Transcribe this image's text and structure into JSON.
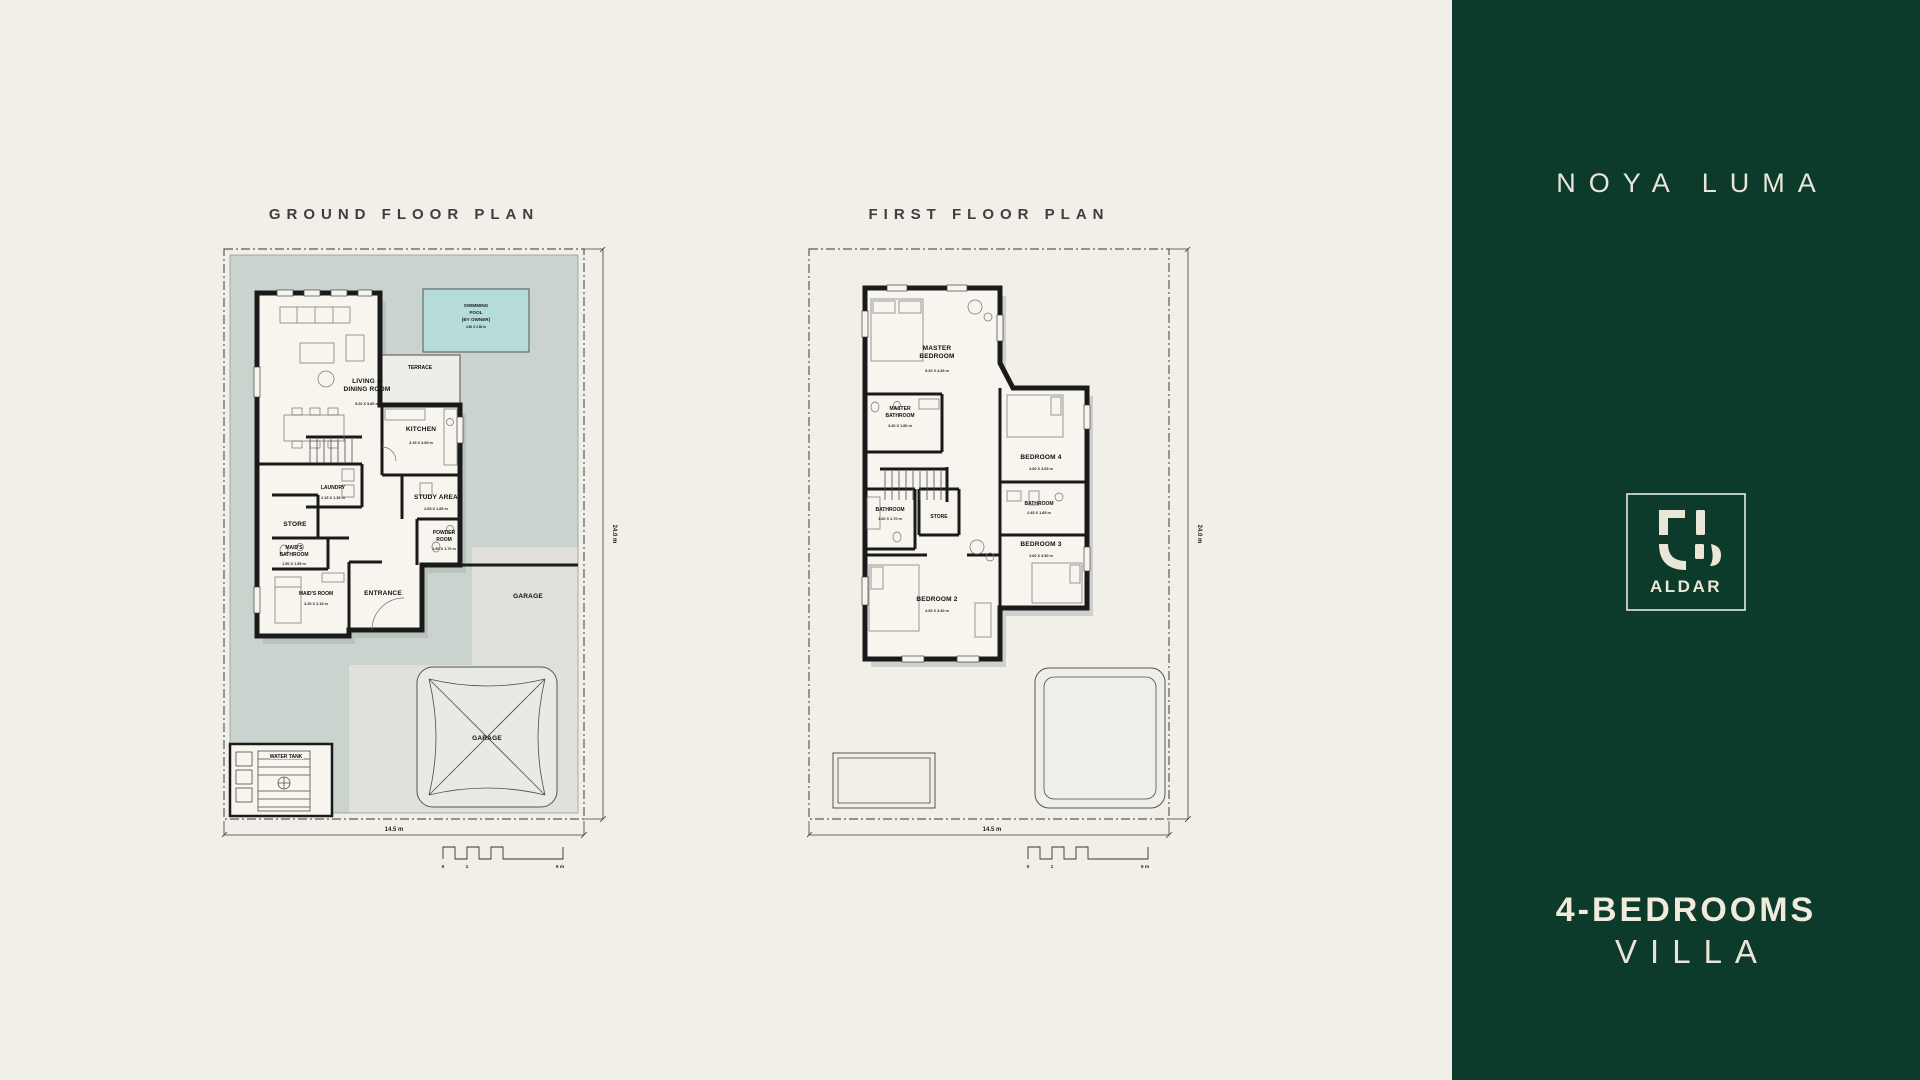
{
  "page": {
    "background": "#f2efe8",
    "panel_background": "#0c3a2b",
    "plot_fill": "#cbd3cf",
    "pool_fill": "#b5dcd9"
  },
  "ground_floor": {
    "title": "GROUND FLOOR PLAN",
    "dims": {
      "width": "14.5 m",
      "depth": "24.0 m"
    },
    "scale_bar": {
      "start": "0",
      "mid": "1",
      "end": "5 m"
    },
    "pool": {
      "line1": "SWIMMING",
      "line2": "POOL",
      "line3": "(BY OWNER)",
      "dim": "4.50 X 2.50 m"
    },
    "rooms": {
      "living": {
        "line1": "LIVING &",
        "line2": "DINING ROOM",
        "dim": "5.20 X 5.80 m"
      },
      "terrace": {
        "name": "TERRACE"
      },
      "kitchen": {
        "name": "KITCHEN",
        "dim": "3.15 X 3.65 m"
      },
      "laundry": {
        "name": "LAUNDRY",
        "dim": "2.15 X 1.35 m"
      },
      "study": {
        "name": "STUDY AREA",
        "dim": "2.65 X 1.85 m"
      },
      "store": {
        "name": "STORE"
      },
      "powder": {
        "line1": "POWDER",
        "line2": "ROOM",
        "dim": "1.50 X 1.70 m"
      },
      "maid_bath": {
        "line1": "MAID'S",
        "line2": "BATHROOM",
        "dim": "1.50 X 1.55 m"
      },
      "maid": {
        "name": "MAID'S ROOM",
        "dim": "3.20 X 2.15 m"
      },
      "entrance": {
        "name": "ENTRANCE"
      },
      "garage_side": {
        "name": "GARAGE"
      },
      "garage_canopy": {
        "name": "GARAGE"
      },
      "water_tank": {
        "name": "WATER TANK"
      }
    }
  },
  "first_floor": {
    "title": "FIRST FLOOR PLAN",
    "dims": {
      "width": "14.5 m",
      "depth": "24.0 m"
    },
    "scale_bar": {
      "start": "0",
      "mid": "1",
      "end": "5 m"
    },
    "rooms": {
      "master": {
        "line1": "MASTER",
        "line2": "BEDROOM",
        "dim": "5.20 X 4.45 m"
      },
      "master_bath": {
        "line1": "MASTER",
        "line2": "BATHROOM",
        "dim": "3.40 X 1.80 m"
      },
      "bedroom4": {
        "name": "BEDROOM 4",
        "dim": "3.60 X 3.65 m"
      },
      "bathroom_right": {
        "name": "BATHROOM",
        "dim": "2.45 X 1.85 m"
      },
      "bedroom3": {
        "name": "BEDROOM 3",
        "dim": "3.60 X 3.50 m"
      },
      "bathroom_left": {
        "name": "BATHROOM",
        "dim": "1.60 X 2.70 m"
      },
      "store": {
        "name": "STORE"
      },
      "bedroom2": {
        "name": "BEDROOM 2",
        "dim": "4.65 X 3.40 m"
      }
    }
  },
  "side_panel": {
    "project_name": "NOYA LUMA",
    "logo_text": "ALDAR",
    "unit_line1": "4-BEDROOMS",
    "unit_line2": "VILLA"
  }
}
